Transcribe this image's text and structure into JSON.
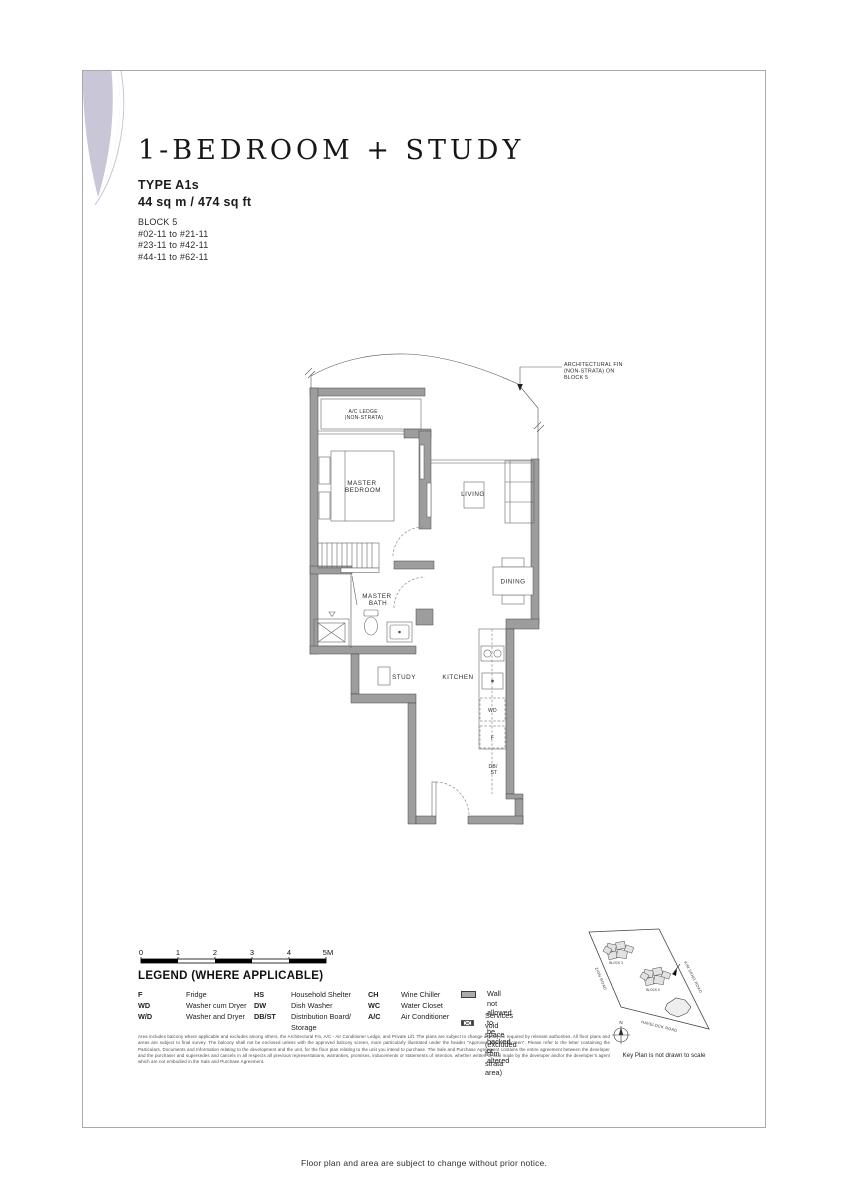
{
  "header": {
    "title": "1-BEDROOM + STUDY",
    "type": "TYPE A1s",
    "area": "44 sq m / 474 sq ft",
    "block": "BLOCK 5",
    "units": [
      "#02-11 to #21-11",
      "#23-11 to #42-11",
      "#44-11 to #62-11"
    ]
  },
  "plan": {
    "fin_label": [
      "ARCHITECTURAL FIN",
      "(NON-STRATA) ON",
      "BLOCK 5"
    ],
    "ac_ledge": [
      "A/C LEDGE",
      "(NON-STRATA)"
    ],
    "rooms": {
      "master_bedroom": [
        "MASTER",
        "BEDROOM"
      ],
      "living": "LIVING",
      "dining": "DINING",
      "master_bath": [
        "MASTER",
        "BATH"
      ],
      "study": "STUDY",
      "kitchen": "KITCHEN",
      "wd": "WD",
      "f": "F",
      "db_st": [
        "DB/",
        "ST"
      ]
    }
  },
  "scale_bar": {
    "ticks": [
      "0",
      "1",
      "2",
      "3",
      "4",
      "5M"
    ]
  },
  "legend": {
    "title": "LEGEND (WHERE APPLICABLE)",
    "columns": [
      [
        {
          "abbr": "F",
          "desc": "Fridge"
        },
        {
          "abbr": "WD",
          "desc": "Washer cum Dryer"
        },
        {
          "abbr": "W/D",
          "desc": "Washer and Dryer"
        }
      ],
      [
        {
          "abbr": "HS",
          "desc": "Household Shelter"
        },
        {
          "abbr": "DW",
          "desc": "Dish Washer"
        },
        {
          "abbr": "DB/ST",
          "desc": "Distribution Board/\nStorage"
        }
      ],
      [
        {
          "abbr": "CH",
          "desc": "Wine Chiller"
        },
        {
          "abbr": "WC",
          "desc": "Water Closet"
        },
        {
          "abbr": "A/C",
          "desc": "Air Conditioner"
        }
      ]
    ],
    "symbols": [
      {
        "name": "wall-no-hack",
        "desc": "Wall not allowed to\nbe hacked or altered"
      },
      {
        "name": "services-void",
        "desc": "Services void space\n(excluded from strata area)"
      }
    ]
  },
  "disclaimer": "Area includes balcony where applicable and excludes among others, the Architectural Fin, A/C - Air Conditioner Ledge, and Private Lift. The plans are subject to change as may be required by relevant authorities. All floor plans and areas are subject to final survey. The balcony shall not be enclosed unless with the approved balcony screen, more particularly illustrated under the header \"Approved Balcony Screen\". Please refer to the letter containing the Particulars, Documents and Information relating to the development and the unit, for the floor plan relating to the unit you intend to purchase. The Sale and Purchase Agreement contains the entire agreement between the developer and the purchaser and supersedes and cancels in all respects all previous representations, warranties, promises, inducements or statements of intention, whether written or oral made by the developer and/or the developer's agent which are not embodied in the Sale and Purchase Agreement.",
  "key_plan": {
    "roads": [
      "ZION ROAD",
      "KIM SENG ROAD",
      "HAVELOCK ROAD"
    ],
    "blocks": [
      "BLOCK 3",
      "BLOCK 5"
    ],
    "compass": "N",
    "caption": "Key Plan is not drawn to scale"
  },
  "page": {
    "footer": "Floor plan and area are subject to change without prior notice."
  },
  "colors": {
    "accent_petal": "#c9c6d8",
    "wall_gray": "#9d9d9d"
  }
}
